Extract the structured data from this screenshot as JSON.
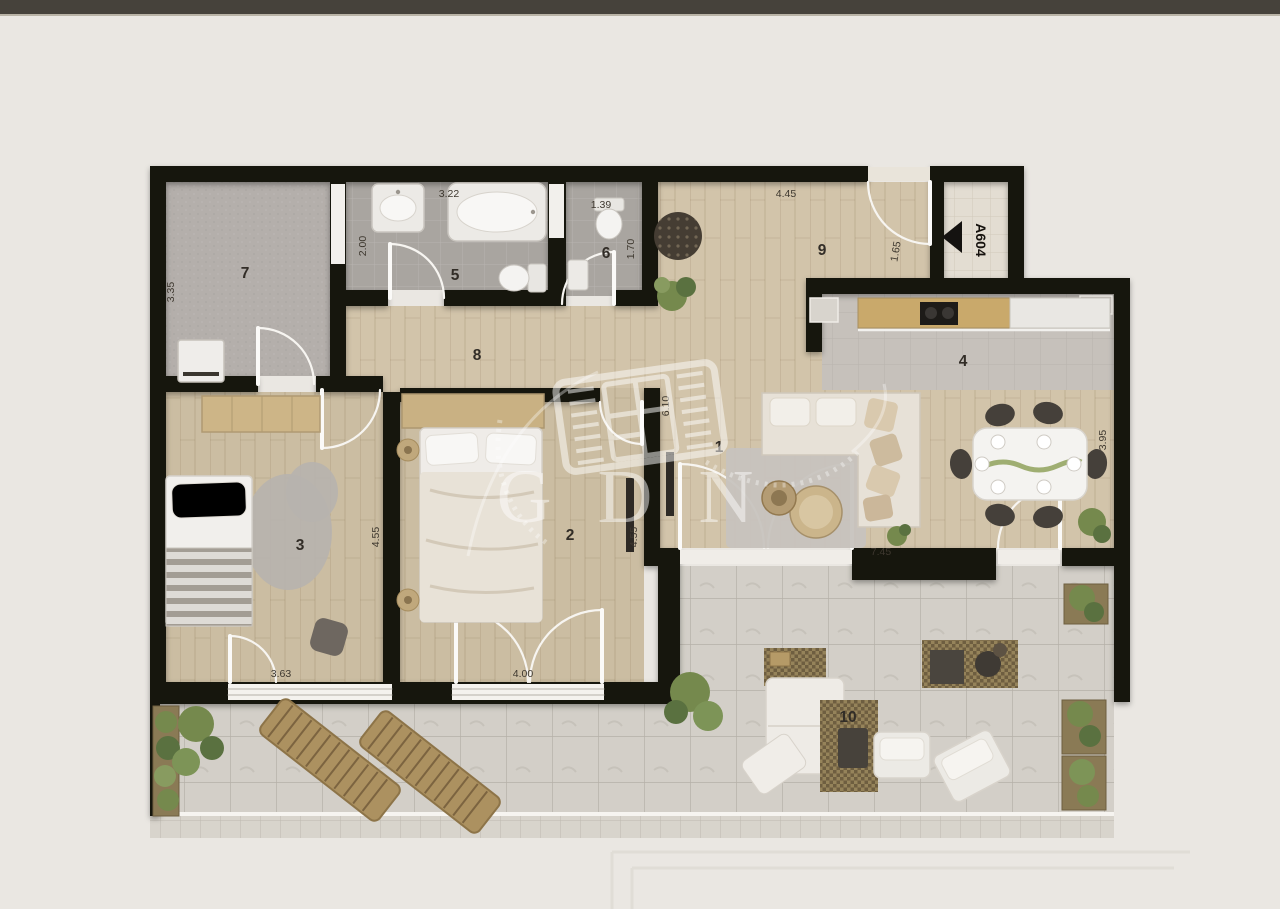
{
  "colors": {
    "bg": "#eae7e2",
    "bar": "#46423b",
    "wall": "#17130f",
    "wood": "#d2c4aa",
    "wood_dark": "#cbbda2",
    "tile": "#a9a5a0",
    "carpet": "#b4afab",
    "kitchen": "#c6c1bb",
    "terrace": "#d3cfc8",
    "corridor": "#e3ddd2",
    "white_furniture": "#efede9",
    "cream": "#e7e1d7",
    "furn_wood": "#c4a977",
    "dark": "#46413a",
    "green": "#75894d",
    "green_dark": "#5a7140",
    "dim": "#3e382f",
    "room": "#322d27",
    "wm": "#ffffff"
  },
  "watermark": {
    "text": "GDN"
  },
  "entrance": {
    "label": "A604"
  },
  "rooms": {
    "living": "1",
    "bedroom_main": "2",
    "bedroom_small": "3",
    "kitchen": "4",
    "bathroom": "5",
    "wc": "6",
    "room7": "7",
    "hallway": "8",
    "entry": "9",
    "terrace": "10"
  },
  "dims": {
    "bath_width": "3.22",
    "bath_depth": "2.00",
    "wc_width": "1.39",
    "wc_depth": "1.70",
    "entry_width": "4.45",
    "entry_door": "1.65",
    "room7_depth": "3.35",
    "living_depth": "6.10",
    "living_width": "7.45",
    "dining_depth": "3.95",
    "bedroom_small_depth": "4.55",
    "bedroom_main_depth": "4.55",
    "bedroom_small_window": "3.63",
    "bedroom_main_window": "4.00"
  }
}
